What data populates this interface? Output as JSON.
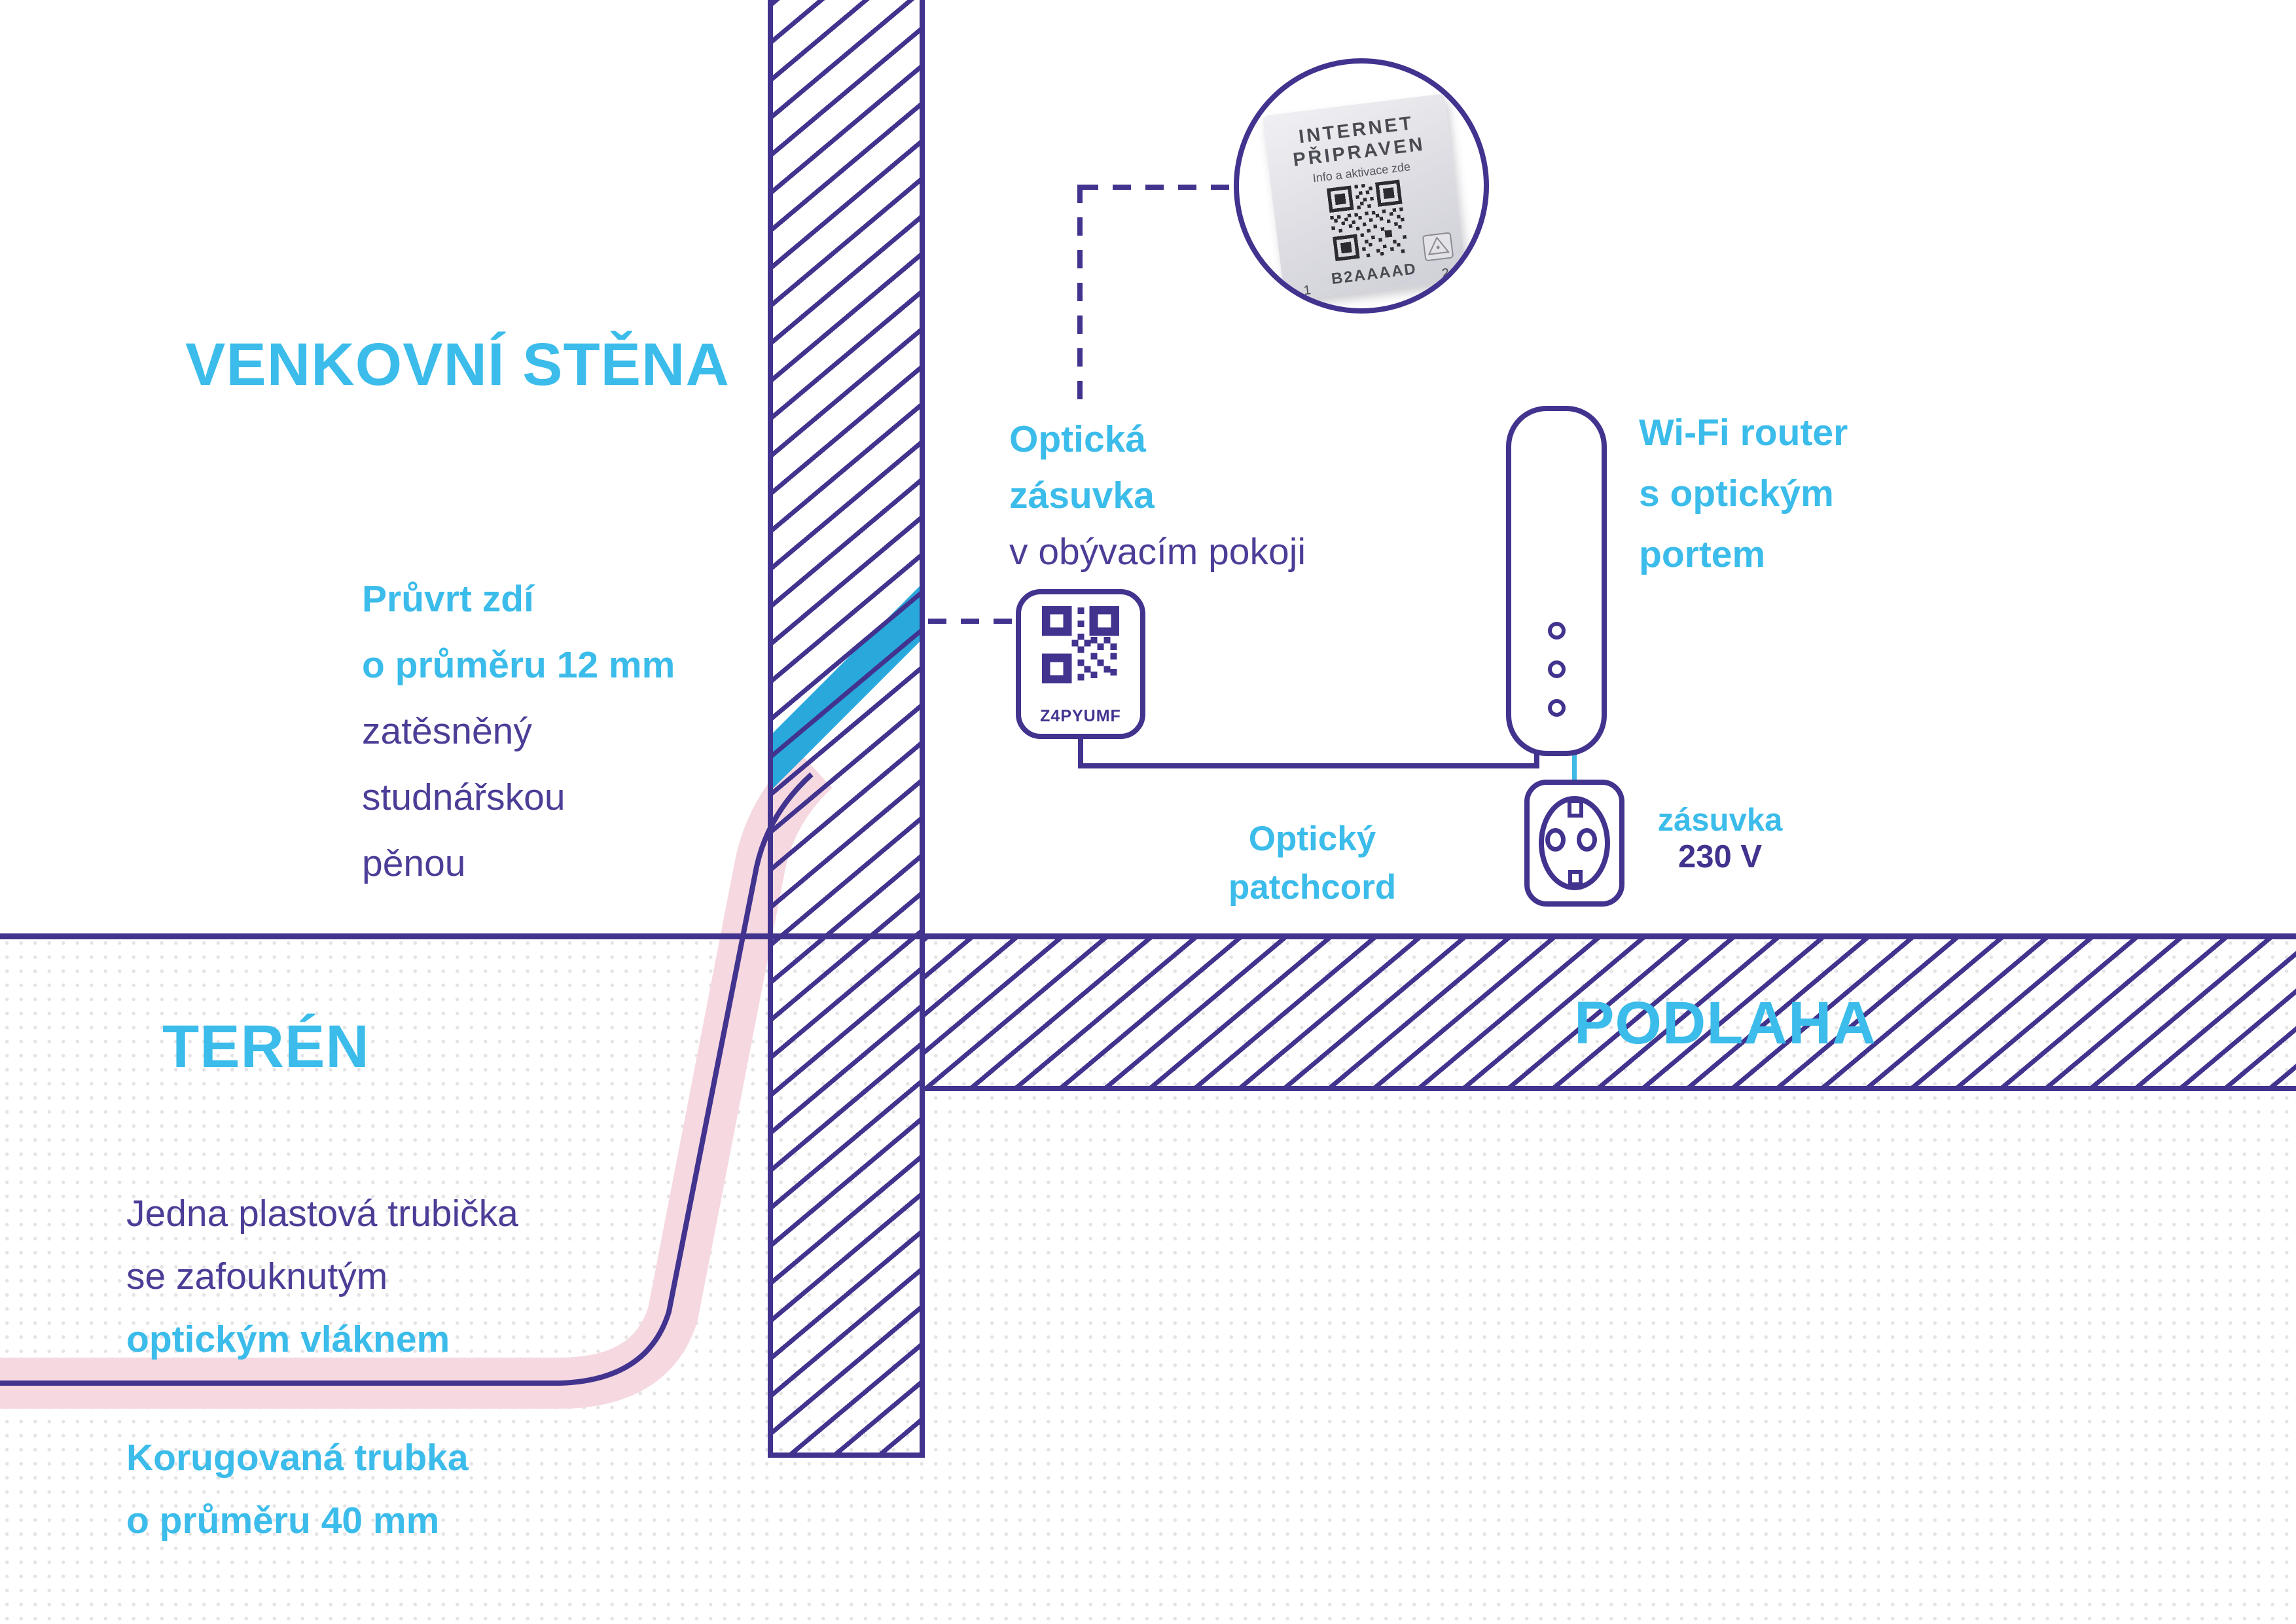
{
  "colors": {
    "line_purple": "#41338E",
    "text_purple": "#4C3D97",
    "accent_cyan": "#3BBCEA",
    "fiber_blue": "#29A8DC",
    "conduit_pink": "#F5D8E0",
    "dots_gray": "#E5E3E4"
  },
  "titles": {
    "outdoor_wall": "VENKOVNÍ STĚNA",
    "terrain": "TERÉN",
    "floor": "PODLAHA"
  },
  "optical_socket": {
    "label_line1": "Optická",
    "label_line2": "zásuvka",
    "label_line3": "v obývacím pokoji",
    "code": "Z4PYUMF"
  },
  "device_photo": {
    "line1": "INTERNET",
    "line2": "PŘIPRAVEN",
    "line3": "Info a aktivace zde",
    "code": "B2AAAAD",
    "port_left": "1",
    "port_right": "2"
  },
  "router_label": {
    "line1": "Wi-Fi router",
    "line2": "s optickým",
    "line3": "portem"
  },
  "patchcord_label": {
    "line1": "Optický",
    "line2": "patchcord"
  },
  "power_outlet_label": {
    "line1": "zásuvka",
    "line2": "230 V"
  },
  "drill_label": {
    "line1": "Průvrt zdí",
    "line2": "o průměru 12 mm",
    "line3": "zatěsněný",
    "line4": "studnářskou",
    "line5": "pěnou"
  },
  "tube_label": {
    "line1": "Jedna plastová trubička",
    "line2": "se zafouknutým",
    "line3": "optickým vláknem"
  },
  "conduit_label": {
    "line1": "Korugovaná trubka",
    "line2": "o průměru 40 mm"
  }
}
